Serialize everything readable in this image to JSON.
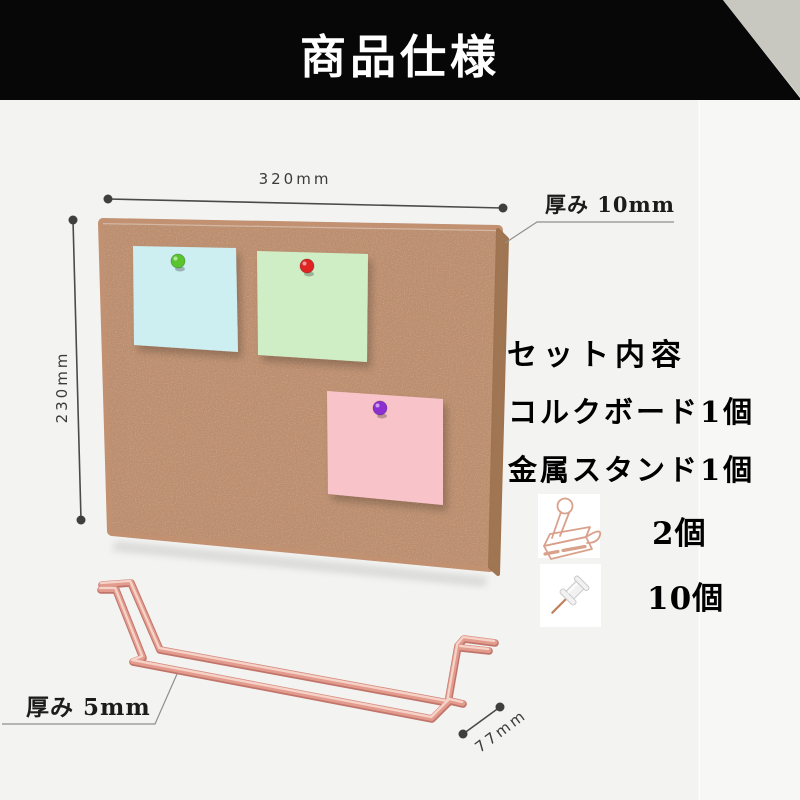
{
  "page": {
    "background": "#f3f3f1",
    "header_bg": "#070707",
    "corner_triangle_color": "#c9c8c0"
  },
  "header": {
    "title": "商品仕様"
  },
  "diagram": {
    "board": {
      "cork_color": "#c19172",
      "cork_side_color": "#a07450",
      "width_label": "320mm",
      "height_label": "230mm",
      "thickness_label": "厚み 10mm",
      "notes": [
        {
          "id": "note-cyan",
          "color": "#cdeff1",
          "pin": "green-pin",
          "pin_color": "#58c52c"
        },
        {
          "id": "note-green",
          "color": "#d0eec6",
          "pin": "red-pin",
          "pin_color": "#e02424"
        },
        {
          "id": "note-pink",
          "color": "#f9c3ca",
          "pin": "purple-pin",
          "pin_color": "#8d30d2"
        }
      ]
    },
    "stand": {
      "wire_color": "#e29b8d",
      "thickness_label": "厚み 5mm",
      "depth_label": "77mm"
    }
  },
  "set_contents": {
    "title": "セット内容",
    "items": [
      {
        "label": "コルクボード1個"
      },
      {
        "label": "金属スタンド1個"
      },
      {
        "icon": "binder-clip-icon",
        "quantity": "2個"
      },
      {
        "icon": "push-pin-icon",
        "quantity": "10個"
      }
    ]
  }
}
